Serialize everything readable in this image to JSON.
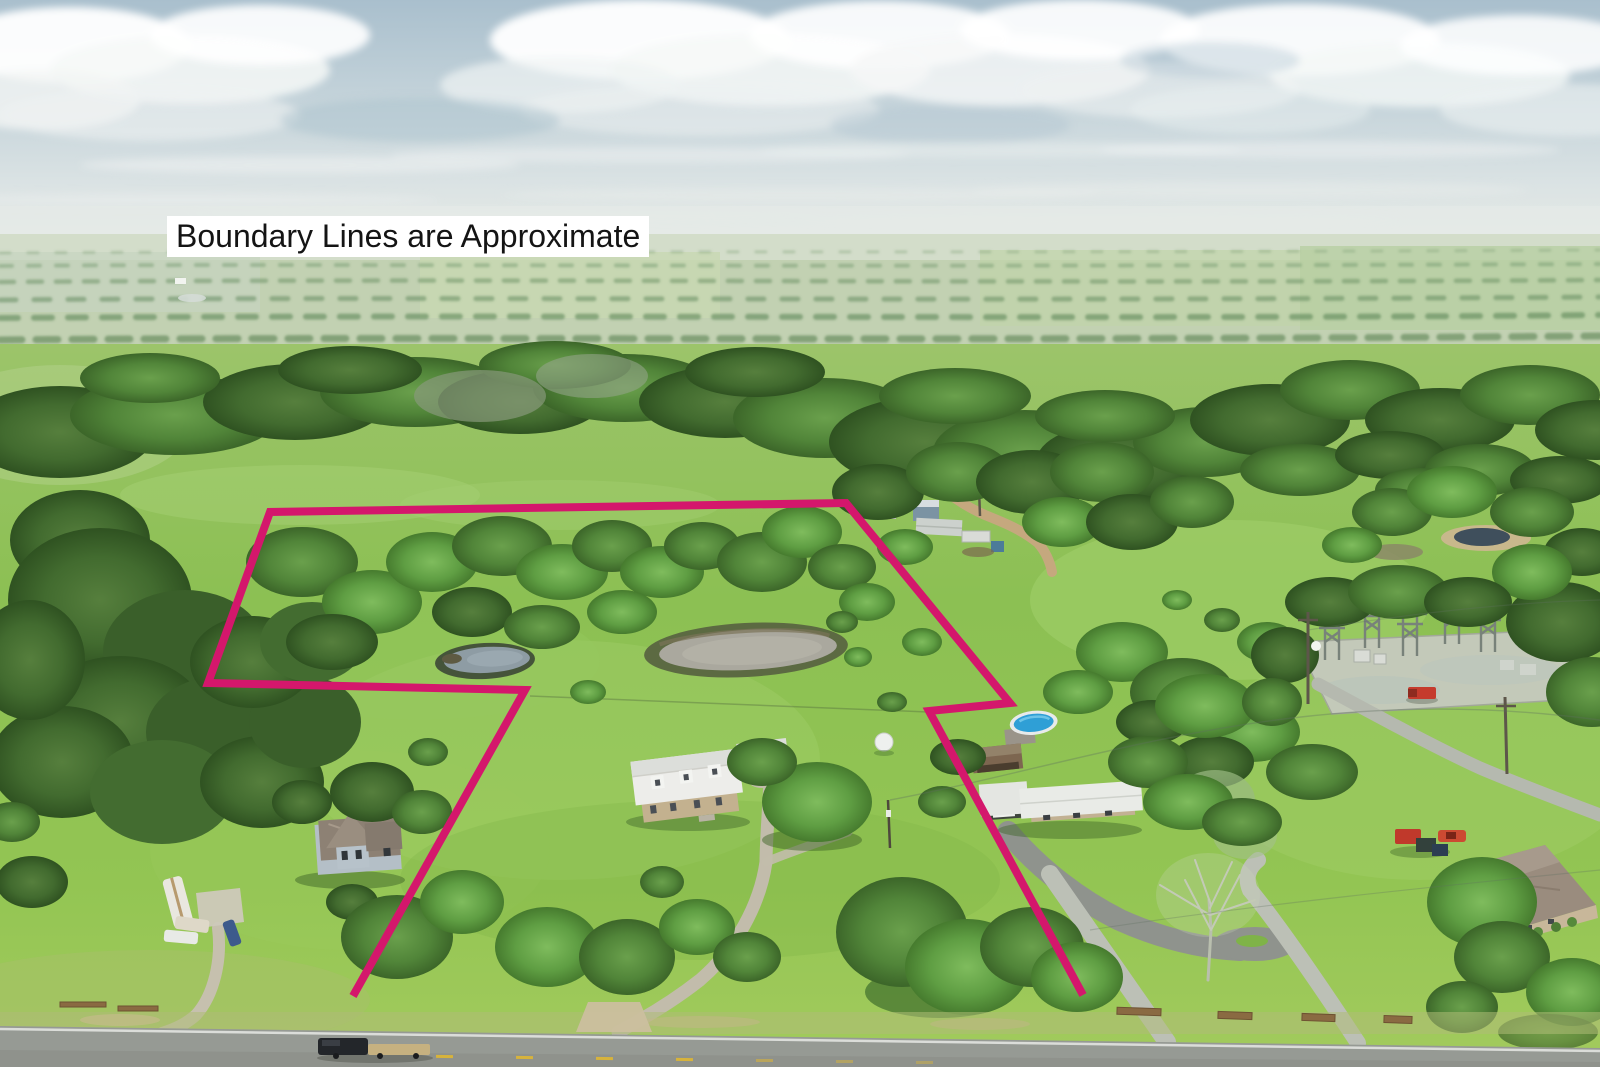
{
  "annotation": {
    "text": "Boundary Lines are Approximate",
    "text_color": "#141414",
    "background": "#ffffff"
  },
  "boundary": {
    "color": "#d4176c",
    "stroke_width": "8",
    "points": "1083,995 929,711 1010,703 846,503 270,512 208,683 525,690 353,996"
  },
  "scene": {
    "type": "aerial-drone-photo-of-rural-property",
    "features": [
      "farmhouse",
      "rv-trailer",
      "van",
      "pickup-truck",
      "blue-car",
      "main-house-white-metal-roof",
      "carport",
      "white-tank",
      "blue-house",
      "storage-barn",
      "shipping-container",
      "blue-shed",
      "neighbor-house",
      "above-ground-pool",
      "rusty-shed",
      "electrical-substation",
      "red-pickup-truck",
      "hip-roof-house",
      "red-tractor",
      "red-car",
      "bare-sycamore-tree",
      "main-pond",
      "small-pond",
      "neighbor-pond",
      "distant-pond",
      "highway",
      "black-truck-with-flatbed-trailer",
      "gravel-driveways",
      "dirt-road"
    ]
  },
  "palette": {
    "sky_top": "#a9bfcd",
    "sky_haze": "#e7ebe6",
    "cloud": "#f6f8f7",
    "field_light": "#a3cb5d",
    "field_mid": "#8cc053",
    "forest_dark": "#3c6629",
    "road_asphalt": "#969a94",
    "gravel": "#c2bcab",
    "dirt_road": "#c5a87e",
    "pond_main_water": "#aaa89e",
    "pond_small_water": "#8e9ca4",
    "pond_neighbor_water": "#3f4f5c",
    "pool_water": "#2f9fd6",
    "lane_marking_yellow": "#d7b33c",
    "truck_red": "#c53b2d"
  }
}
